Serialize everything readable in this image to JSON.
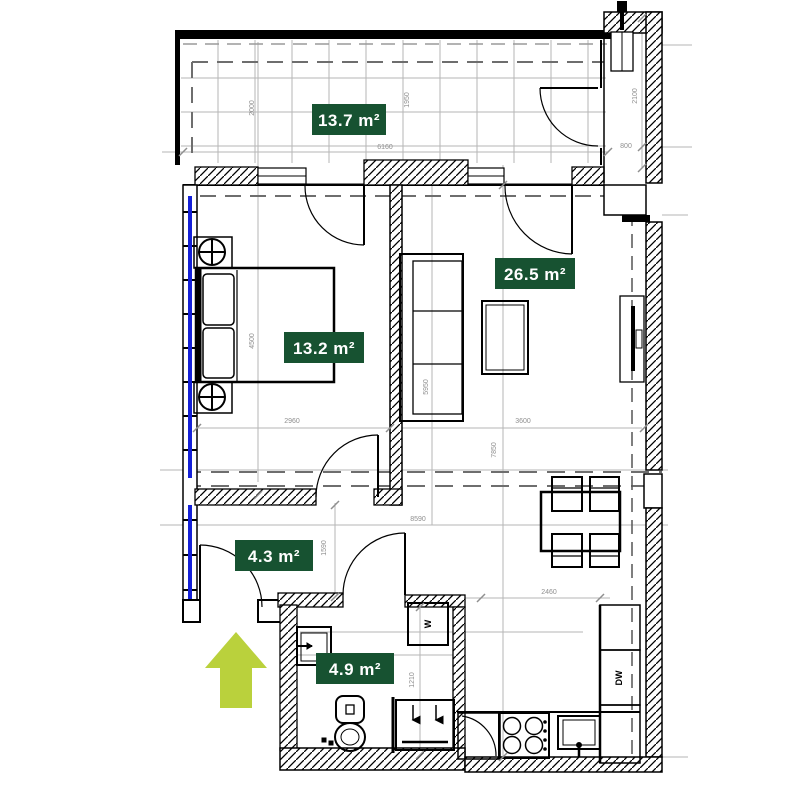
{
  "plan": {
    "rooms": {
      "balcony": {
        "area": "13.7 m²"
      },
      "living": {
        "area": "26.5 m²"
      },
      "bedroom": {
        "area": "13.2 m²"
      },
      "hall": {
        "area": "4.3 m²"
      },
      "bathroom": {
        "area": "4.9 m²"
      }
    },
    "appliances": {
      "washer": "W",
      "dishwasher": "DW"
    },
    "dimensions": {
      "balcony_width": "6160",
      "balcony_depth_left": "2000",
      "balcony_depth_right": "1950",
      "shaft_height": "2100",
      "shaft_width": "800",
      "bedroom_depth": "4500",
      "bedroom_width": "2960",
      "living_depth": "5950",
      "living_width": "3600",
      "apartment_depth": "7850",
      "apartment_width": "8590",
      "hall_depth": "1590",
      "bathroom_width": "1210",
      "kitchen_width": "2460"
    },
    "colors": {
      "label_bg": "#175231",
      "label_text": "#ffffff",
      "window": "#1420d8",
      "arrow": "#bad13c",
      "dim_text": "#8f8f8f"
    }
  }
}
